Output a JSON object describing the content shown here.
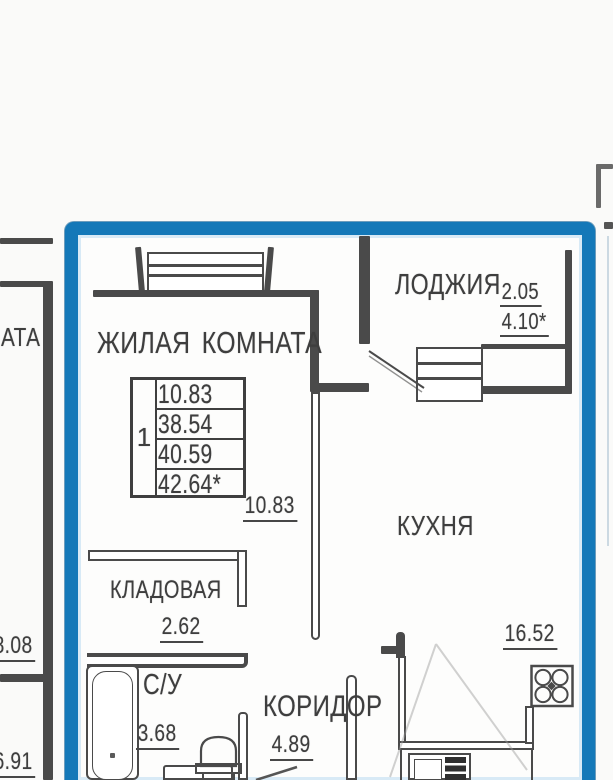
{
  "floor_plan": {
    "colors": {
      "highlight": "#1478b8",
      "wall": "#4a4a4a",
      "text": "#3e3e3e"
    },
    "unit": {
      "table": {
        "number": "1",
        "rows": [
          "10.83",
          "38.54",
          "40.59",
          "42.64*"
        ]
      },
      "living_room": {
        "name": "ЖИЛАЯ КОМНАТА",
        "area": "10.83"
      },
      "loggia": {
        "name": "ЛОДЖИЯ",
        "dim_width": "2.05",
        "dim_area": "4.10*"
      },
      "kitchen": {
        "name": "КУХНЯ",
        "area": "16.52"
      },
      "storage": {
        "name": "КЛАДОВАЯ",
        "area": "2.62"
      },
      "bathroom": {
        "name": "С/У",
        "area": "3.68"
      },
      "corridor": {
        "name": "КОРИДОР",
        "area": "4.89"
      }
    },
    "neighbor_left": {
      "room_name_fragment": "АТА",
      "dim_top": "8.08",
      "dim_bottom": "6.91"
    }
  }
}
